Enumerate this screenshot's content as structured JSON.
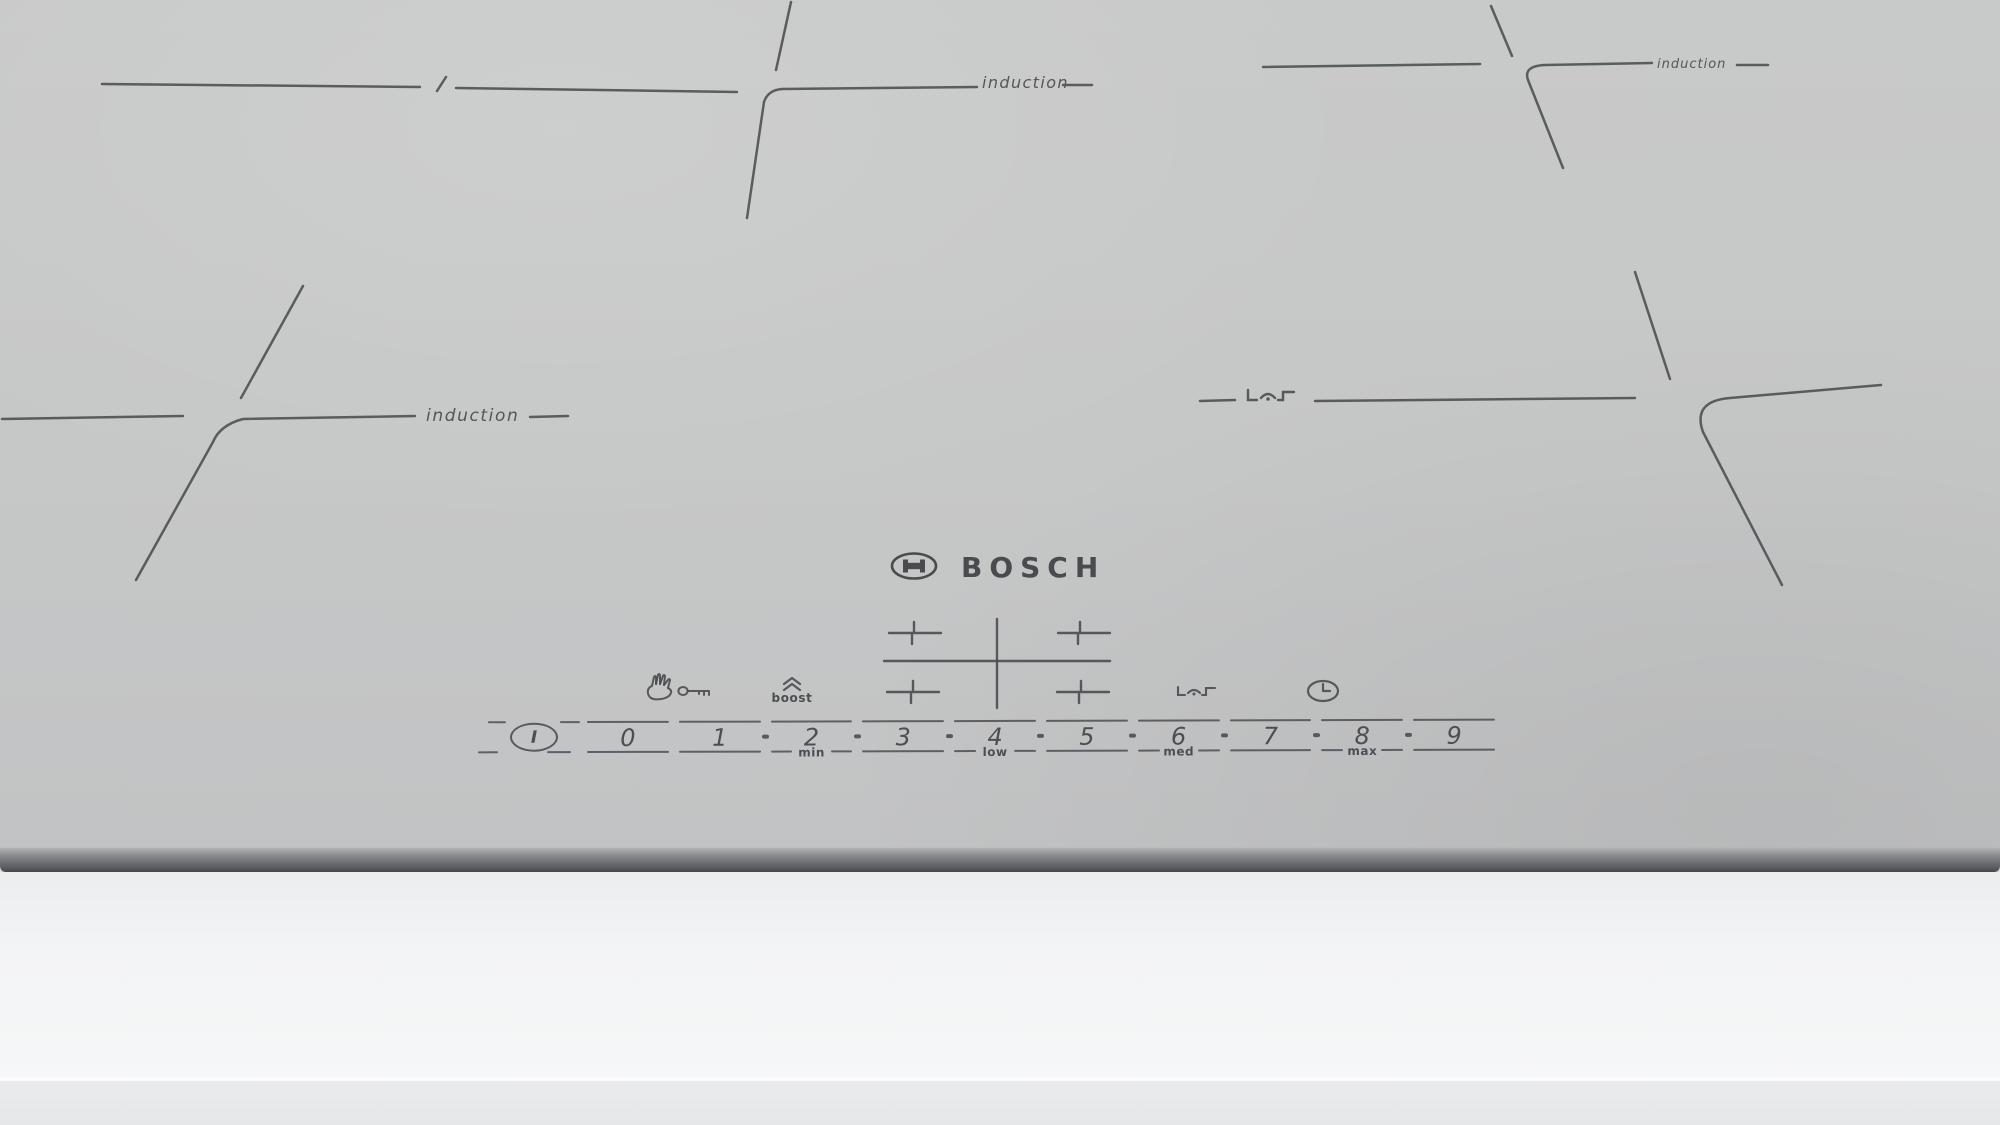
{
  "brand": {
    "name": "BOSCH"
  },
  "zones": {
    "top_center": {
      "label": "induction"
    },
    "top_right": {
      "label": "induction"
    },
    "left": {
      "label": "induction"
    }
  },
  "controls": {
    "power": "I",
    "levels": [
      "0",
      "1",
      "2",
      "3",
      "4",
      "5",
      "6",
      "7",
      "8",
      "9"
    ],
    "sublabels": {
      "2": "min",
      "4": "low",
      "6": "med",
      "8": "max"
    },
    "boost": "boost",
    "icons": [
      "child-lock-hand-icon",
      "key-icon",
      "boost-chevrons-icon",
      "zone-select-cross",
      "pan-sensor-icon",
      "timer-clock-icon"
    ]
  },
  "colors": {
    "surface": "#c6c7c7",
    "marking": "#4b4f52",
    "logo": "#494c4f",
    "front_edge": "#6b6d70",
    "counter": "#f3f4f5"
  }
}
